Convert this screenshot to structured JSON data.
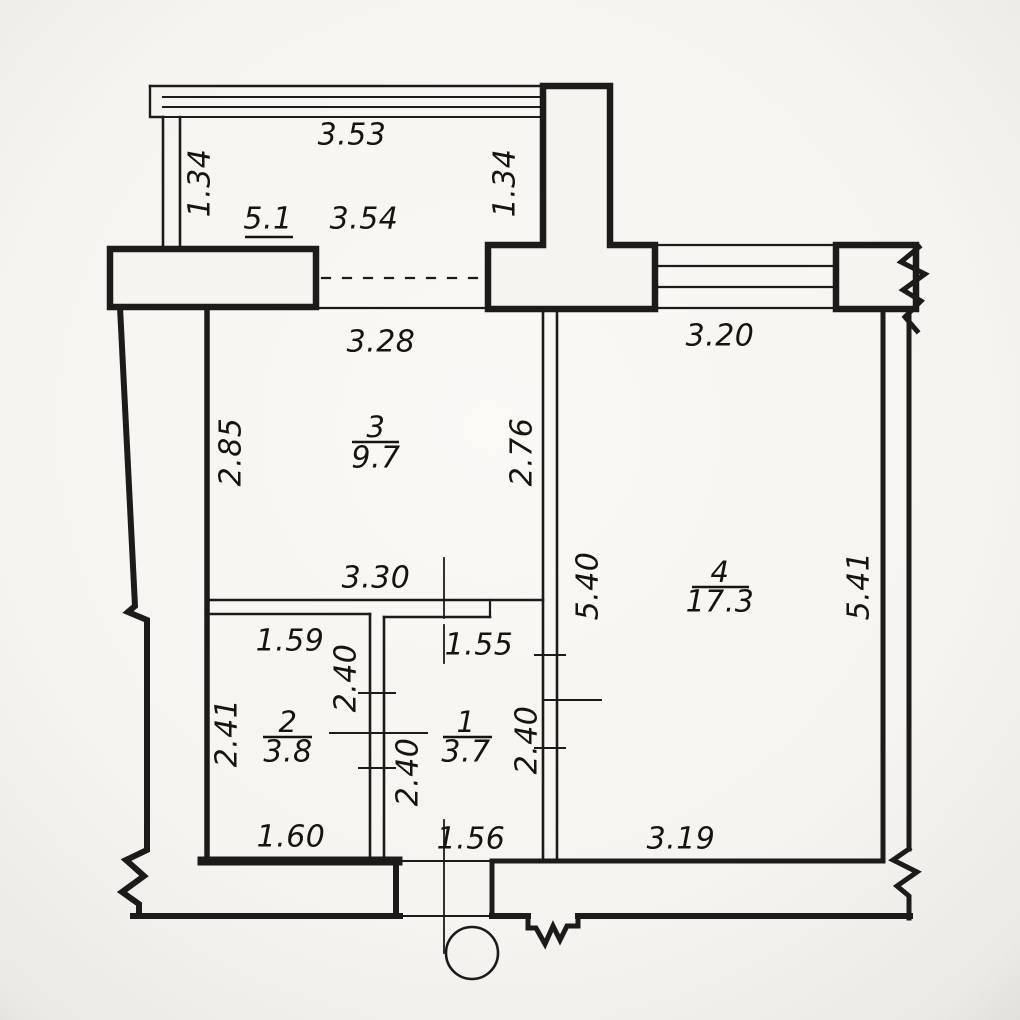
{
  "plan": {
    "type": "apartment-floor-plan",
    "background_color": "#f6f4f0",
    "line_color": "#1c1b19",
    "rooms": [
      {
        "id": "room-3",
        "number": "3",
        "area": "9.7",
        "x": 376,
        "number_y": 427,
        "line_y": 442,
        "area_y": 458,
        "line_x1": 352,
        "line_x2": 399
      },
      {
        "id": "room-4",
        "number": "4",
        "area": "17.3",
        "x": 720,
        "number_y": 572,
        "line_y": 587,
        "area_y": 602,
        "line_x1": 692,
        "line_x2": 749
      },
      {
        "id": "room-2",
        "number": "2",
        "area": "3.8",
        "x": 288,
        "number_y": 722,
        "line_y": 737,
        "area_y": 752,
        "line_x1": 263,
        "line_x2": 312
      },
      {
        "id": "room-1",
        "number": "1",
        "area": "3.7",
        "x": 466,
        "number_y": 722,
        "line_y": 737,
        "area_y": 752,
        "line_x1": 443,
        "line_x2": 492
      },
      {
        "id": "balcony",
        "number": "",
        "area": "5.1",
        "x": 268,
        "number_y": 0,
        "line_y": 237,
        "area_y": 219,
        "line_x1": 245,
        "line_x2": 293
      }
    ],
    "dimensions": [
      {
        "text": "3.53",
        "x": 352,
        "y": 135,
        "rot": 0
      },
      {
        "text": "1.34",
        "x": 200,
        "y": 183,
        "rot": -90
      },
      {
        "text": "1.34",
        "x": 505,
        "y": 183,
        "rot": -90
      },
      {
        "text": "3.54",
        "x": 364,
        "y": 219,
        "rot": 0
      },
      {
        "text": "3.28",
        "x": 381,
        "y": 342,
        "rot": 0
      },
      {
        "text": "3.20",
        "x": 720,
        "y": 336,
        "rot": 0
      },
      {
        "text": "2.85",
        "x": 231,
        "y": 452,
        "rot": -90
      },
      {
        "text": "2.76",
        "x": 522,
        "y": 452,
        "rot": -90
      },
      {
        "text": "5.40",
        "x": 588,
        "y": 586,
        "rot": -90
      },
      {
        "text": "5.41",
        "x": 859,
        "y": 586,
        "rot": -90
      },
      {
        "text": "3.30",
        "x": 376,
        "y": 578,
        "rot": 0
      },
      {
        "text": "1.59",
        "x": 290,
        "y": 641,
        "rot": 0
      },
      {
        "text": "1.55",
        "x": 479,
        "y": 645,
        "rot": 0
      },
      {
        "text": "2.40",
        "x": 346,
        "y": 678,
        "rot": -90
      },
      {
        "text": "2.41",
        "x": 227,
        "y": 733,
        "rot": -90
      },
      {
        "text": "2.40",
        "x": 408,
        "y": 772,
        "rot": -90
      },
      {
        "text": "2.40",
        "x": 527,
        "y": 740,
        "rot": -90
      },
      {
        "text": "1.60",
        "x": 291,
        "y": 837,
        "rot": 0
      },
      {
        "text": "1.56",
        "x": 471,
        "y": 839,
        "rot": 0
      },
      {
        "text": "3.19",
        "x": 681,
        "y": 839,
        "rot": 0
      }
    ]
  }
}
